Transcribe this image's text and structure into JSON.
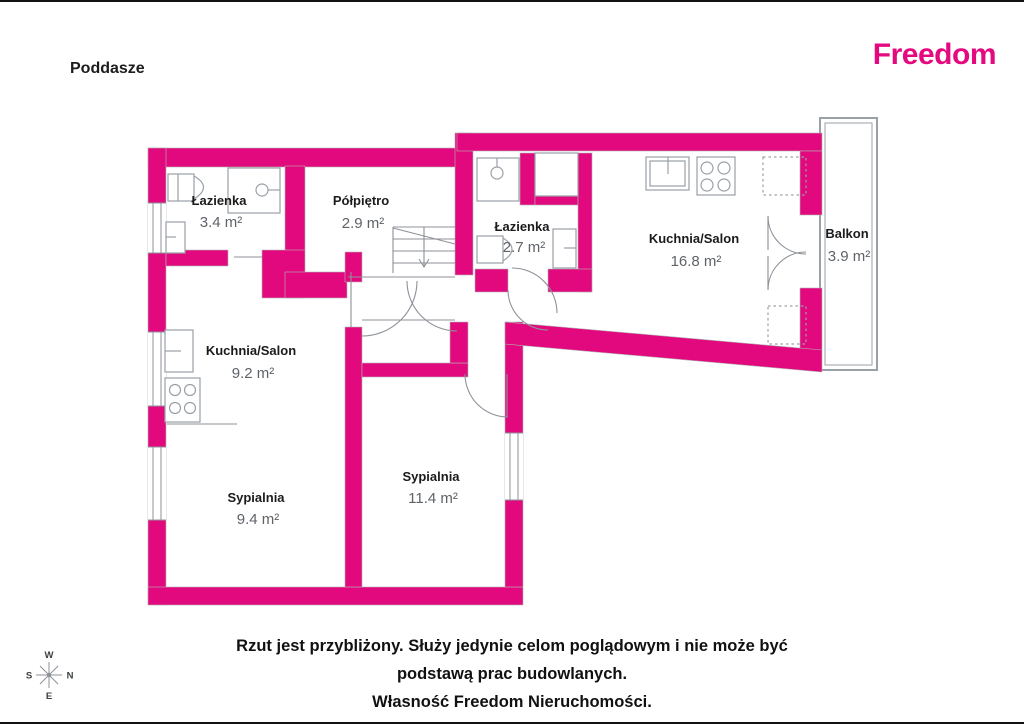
{
  "header": {
    "title": "Poddasze",
    "brand": "Freedom"
  },
  "colors": {
    "wall_pink": "#E2097E",
    "brand_pink": "#E5097F",
    "fixture_line_gray": "#9aa0a6",
    "area_text_gray": "#5f6368"
  },
  "rooms": [
    {
      "name": "Łazienka",
      "area": "3.4 m²"
    },
    {
      "name": "Półpiętro",
      "area": "2.9 m²"
    },
    {
      "name": "Łazienka",
      "area": "2.7 m²"
    },
    {
      "name": "Kuchnia/Salon",
      "area": "16.8 m²"
    },
    {
      "name": "Balkon",
      "area": "3.9 m²"
    },
    {
      "name": "Kuchnia/Salon",
      "area": "9.2 m²"
    },
    {
      "name": "Sypialnia",
      "area": "9.4 m²"
    },
    {
      "name": "Sypialnia",
      "area": "11.4 m²"
    }
  ],
  "fixtures": [
    "toilet-icon",
    "shower-icon",
    "sink-icon",
    "stove-icon",
    "stairs-icon",
    "wardrobe-dashed-icon",
    "balcony-door-icon",
    "compass-rose-icon"
  ],
  "compass": {
    "top": "W",
    "right": "N",
    "left": "S",
    "bottom": "E"
  },
  "footer": {
    "lines": [
      "Rzut jest przybliżony. Służy jedynie celom poglądowym i nie może być",
      "podstawą prac budowlanych.",
      "Własność Freedom Nieruchomości."
    ]
  }
}
